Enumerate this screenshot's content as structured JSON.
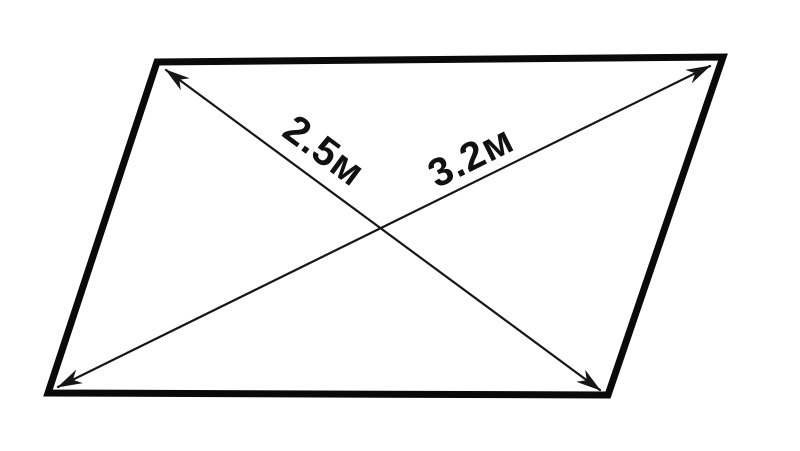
{
  "diagram": {
    "title": "parallelogram-with-diagonals",
    "background_color": "#ffffff",
    "stroke_color": "#0a0a0a",
    "parallelogram": {
      "points": "157,62 723,57 608,395 48,393"
    },
    "diagonals": [
      {
        "id": "top-left-to-bottom-right",
        "path": "M166,70 L600,390",
        "label": "2.5м"
      },
      {
        "id": "bottom-left-to-top-right",
        "path": "M58,387 L710,66",
        "label": "3.2м"
      }
    ]
  }
}
